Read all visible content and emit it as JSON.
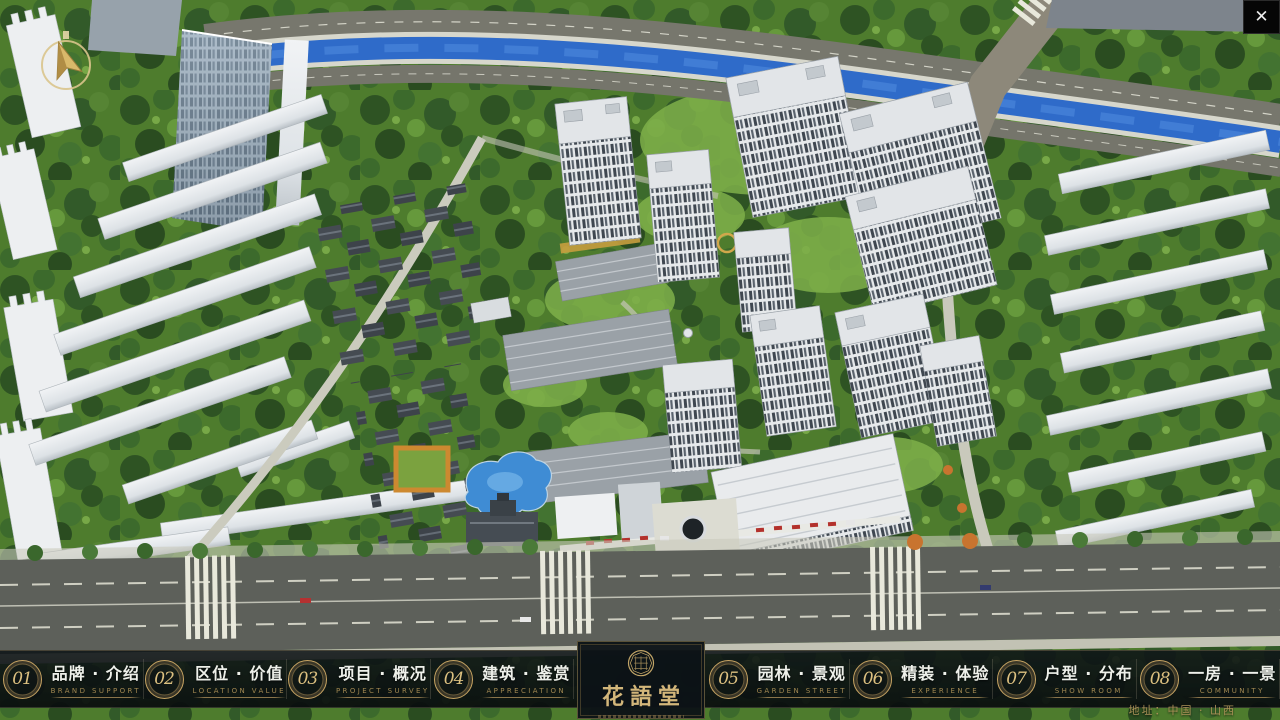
{
  "chrome": {
    "close": "✕"
  },
  "logo": {
    "title": "花語堂"
  },
  "menu": {
    "items": [
      {
        "num": "01",
        "zh": "品牌 · 介绍",
        "en": "BRAND SUPPORT"
      },
      {
        "num": "02",
        "zh": "区位 · 价值",
        "en": "LOCATION VALUE"
      },
      {
        "num": "03",
        "zh": "项目 · 概况",
        "en": "PROJECT SURVEY"
      },
      {
        "num": "04",
        "zh": "建筑 · 鉴赏",
        "en": "APPRECIATION"
      },
      {
        "num": "05",
        "zh": "园林 · 景观",
        "en": "GARDEN STREET"
      },
      {
        "num": "06",
        "zh": "精装 · 体验",
        "en": "EXPERIENCE"
      },
      {
        "num": "07",
        "zh": "户型 · 分布",
        "en": "SHOW ROOM"
      },
      {
        "num": "08",
        "zh": "一房 · 一景",
        "en": "COMMUNITY"
      }
    ]
  },
  "footer": {
    "address": "地址：中国 · 山西"
  },
  "scene": {
    "description": "3D aerial masterplan render of residential community with canal, towers and south entrance"
  },
  "colors": {
    "gold": "#c7a463",
    "bar_bg": "#0b1114",
    "river_blue": "#2f6bc9",
    "grass_green": "#4e7c2d",
    "road_gray": "#6e6e64",
    "building_white": "#e8eaec",
    "accent_red": "#b3312c"
  }
}
